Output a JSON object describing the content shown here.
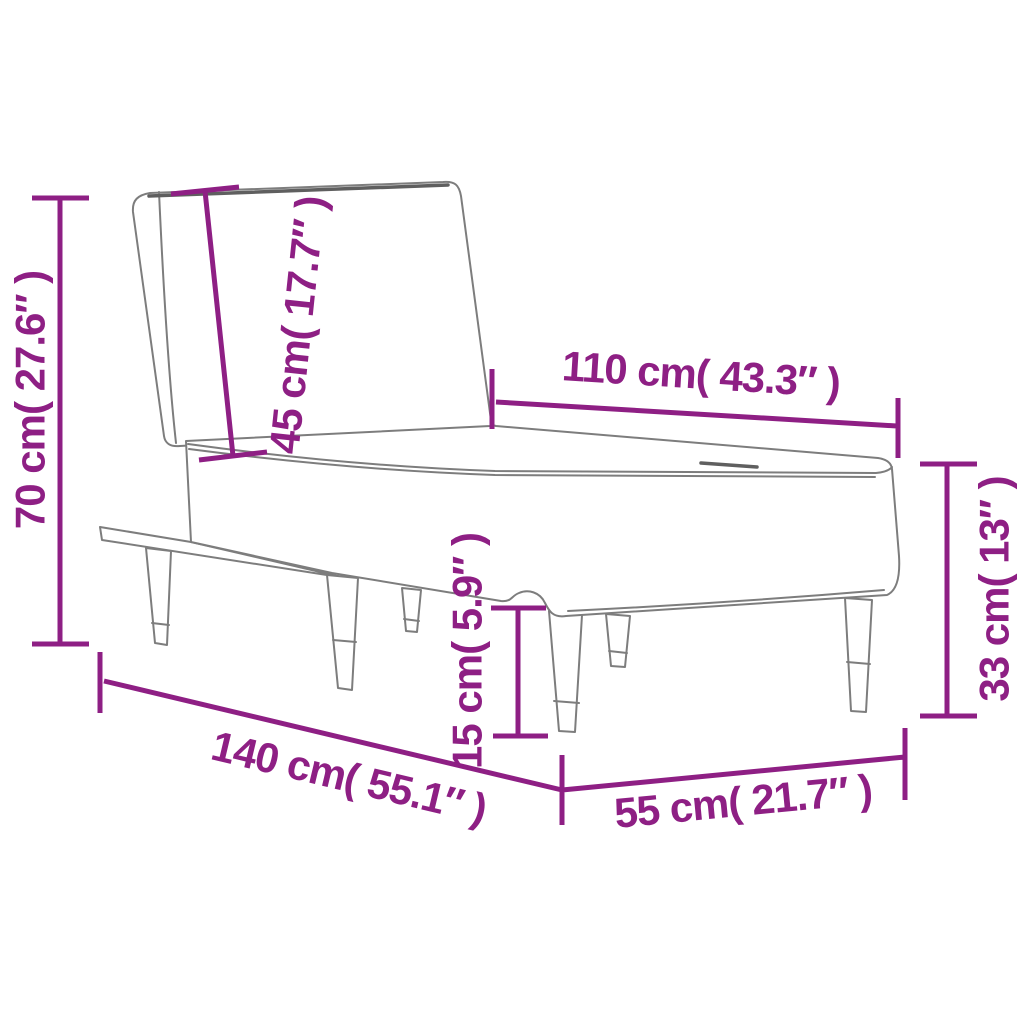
{
  "theme": {
    "accent_color": "#8e1f84",
    "drawing_line_color": "#7d7d7d",
    "background_color": "#ffffff"
  },
  "diagram": {
    "dimensions": {
      "total_height": {
        "cm": 70,
        "inches": 27.6,
        "label": "70 cm( 27.6″ )"
      },
      "backrest_height": {
        "cm": 45,
        "inches": 17.7,
        "label": "45 cm( 17.7″ )"
      },
      "seat_length": {
        "cm": 110,
        "inches": 43.3,
        "label": "110 cm( 43.3″ )"
      },
      "side_height": {
        "cm": 33,
        "inches": 13,
        "label": "33 cm( 13″ )"
      },
      "leg_height": {
        "cm": 15,
        "inches": 5.9,
        "label": "15 cm( 5.9″ )"
      },
      "total_length": {
        "cm": 140,
        "inches": 55.1,
        "label": "140 cm( 55.1″ )"
      },
      "depth": {
        "cm": 55,
        "inches": 21.7,
        "label": "55 cm( 21.7″ )"
      }
    }
  }
}
